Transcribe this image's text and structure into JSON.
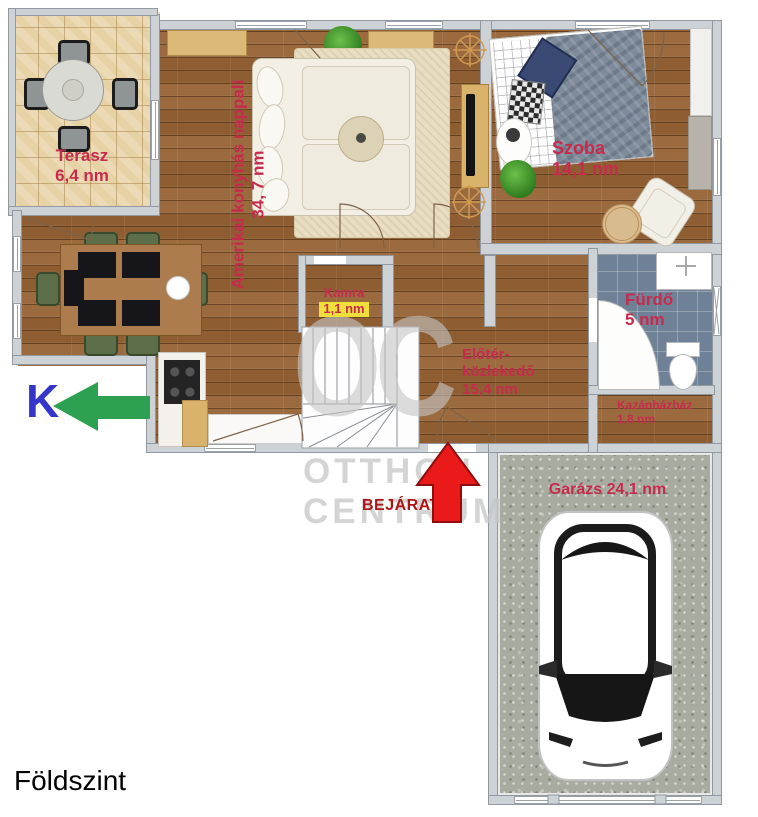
{
  "floor_label": "Földszint",
  "compass": {
    "letter": "K"
  },
  "entrance": {
    "label": "BEJÁRAT"
  },
  "watermark": {
    "monogram": "OC",
    "line1": "OTTHON",
    "line2": "CENTRUM"
  },
  "rooms": {
    "terasz": {
      "name": "Terasz",
      "area": "6,4 nm"
    },
    "nappali": {
      "name": "Amerikai konyhás nappali",
      "area": "34, 7 nm"
    },
    "szoba": {
      "name": "Szoba",
      "area": "14,1 nm"
    },
    "kamra": {
      "name": "Kamra",
      "area": "1,1 nm"
    },
    "elokozlekedo": {
      "name_line1": "Előtér-",
      "name_line2": "közlekedő",
      "area": "15,4 nm"
    },
    "furdo": {
      "name": "Fürdő",
      "area": "5 nm"
    },
    "kazanhaz": {
      "name": "Kazánházház",
      "area": "1,8 nm"
    },
    "garazs": {
      "label": "Garázs 24,1 nm"
    }
  },
  "colors": {
    "room_label": "#c62b4d",
    "entrance_label": "#b11414",
    "entrance_arrow": "#ea1a1a",
    "compass_arrow": "#2da052",
    "compass_letter": "#3535cc",
    "kamra_area_highlight": "#f0df3a",
    "watermark_gray": "#c6c6c6"
  }
}
